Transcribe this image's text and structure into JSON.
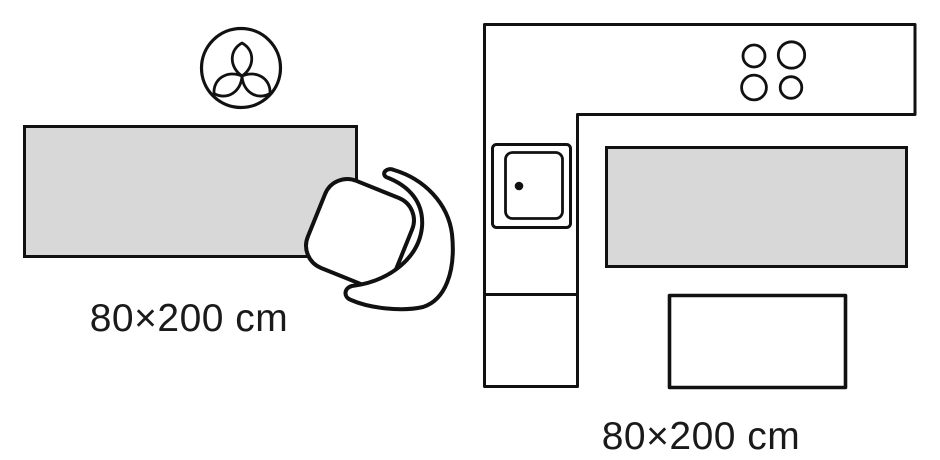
{
  "scenes": {
    "living_room": {
      "size_label": "80×200 cm",
      "icons": [
        "plant-top-view-icon",
        "rug-swatch",
        "armchair-top-view-icon"
      ]
    },
    "kitchen": {
      "size_label": "80×200 cm",
      "icons": [
        "kitchen-counter-outline",
        "stove-burners-icon",
        "sink-icon",
        "rug-runner-swatch",
        "table-outline"
      ]
    }
  },
  "colors": {
    "outline": "#111111",
    "rug_fill": "#d8d8d8",
    "text": "#1a1a1a",
    "background": "#ffffff"
  }
}
